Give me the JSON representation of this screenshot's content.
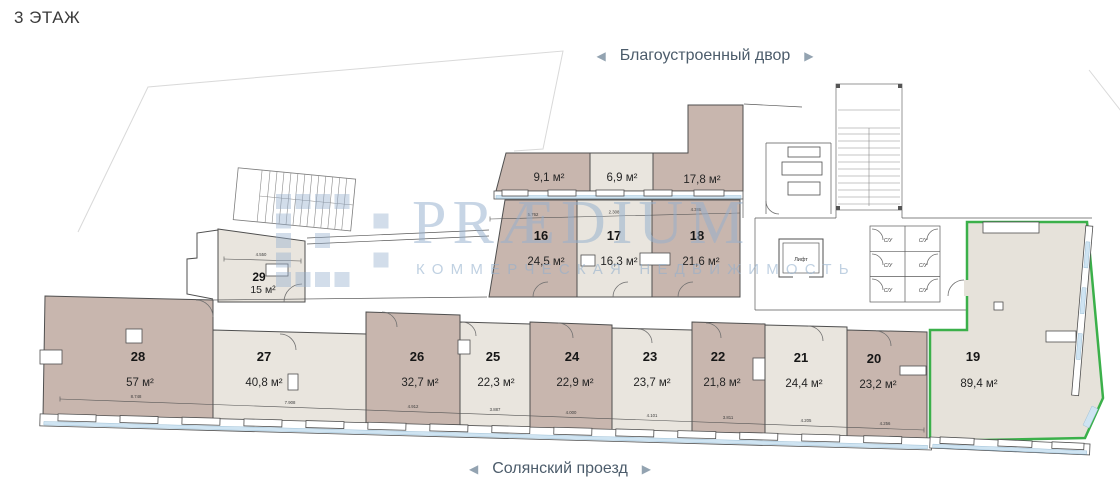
{
  "page": {
    "floor_label": "3 ЭТАЖ"
  },
  "nav": {
    "top_street": {
      "prev": "◀",
      "label": "Благоустроенный двор",
      "next": "▶"
    },
    "bottom_street": {
      "prev": "◀",
      "label": "Солянский проезд",
      "next": "▶"
    }
  },
  "watermark": {
    "brand": "PRÆDIUM",
    "tagline": "КОММЕРЧЕСКАЯ НЕДВИЖИМОСТЬ"
  },
  "facilities": {
    "elevator": "Лифт",
    "wc": "С/У"
  },
  "rooms": {
    "a91": {
      "area": "9,1 м²"
    },
    "a69": {
      "area": "6,9 м²"
    },
    "a178": {
      "area": "17,8 м²"
    },
    "r16": {
      "number": "16",
      "area": "24,5 м²"
    },
    "r17": {
      "number": "17",
      "area": "16,3 м²"
    },
    "r18": {
      "number": "18",
      "area": "21,6 м²"
    },
    "r29": {
      "number": "29",
      "area": "15 м²"
    },
    "r28": {
      "number": "28",
      "area": "57 м²"
    },
    "r27": {
      "number": "27",
      "area": "40,8 м²"
    },
    "r26": {
      "number": "26",
      "area": "32,7 м²"
    },
    "r25": {
      "number": "25",
      "area": "22,3 м²"
    },
    "r24": {
      "number": "24",
      "area": "22,9 м²"
    },
    "r23": {
      "number": "23",
      "area": "23,7 м²"
    },
    "r22": {
      "number": "22",
      "area": "21,8 м²"
    },
    "r21": {
      "number": "21",
      "area": "24,4 м²"
    },
    "r20": {
      "number": "20",
      "area": "23,2 м²"
    },
    "r19": {
      "number": "19",
      "area": "89,4 м²",
      "highlighted": true
    }
  },
  "dimensions": {
    "d16": "5.762",
    "d17": "2.308",
    "d18": "4.385",
    "d29": "4.550",
    "d28": "8.748",
    "d27": "7.908",
    "d26": "4.912",
    "d25": "3.887",
    "d24": "4.000",
    "d23": "4.101",
    "d22": "3.811",
    "d21": "4.205",
    "d20": "4.256"
  },
  "colors": {
    "highlight_green": "#3bb04a",
    "room_dark": "#c8b6ae",
    "room_light": "#e9e5de",
    "glass_blue": "#cfe4f2",
    "watermark_blue": "#93afcd"
  }
}
